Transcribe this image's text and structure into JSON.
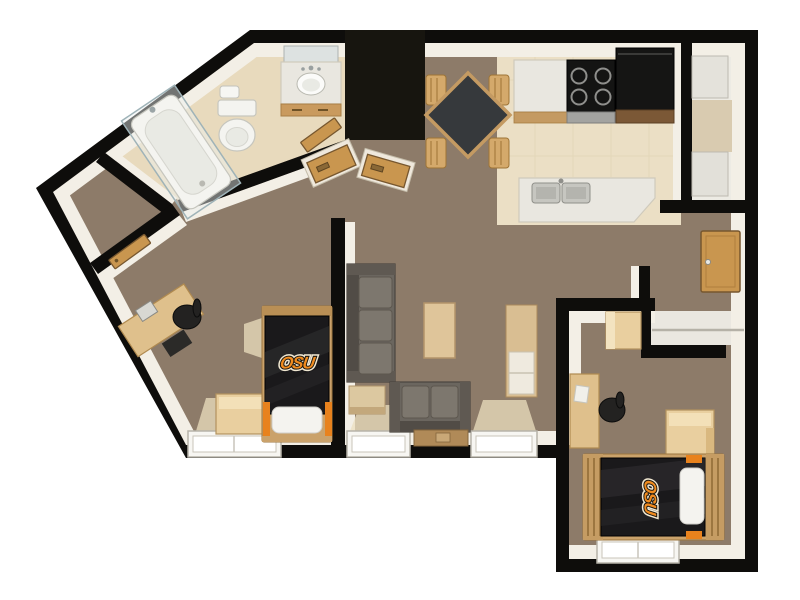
{
  "scene": {
    "type": "3d-floor-plan",
    "description": "Top-down 3D rendering of a two-bedroom university apartment with OSU-branded bedding",
    "brand": "OSU"
  },
  "colors": {
    "background": "#ffffff",
    "wall": "#0e0d0b",
    "wall_face": "#f3efe6",
    "carpet": "#8d7b69",
    "tile_bathroom": "#e8dabd",
    "tile_kitchen": "#ebdfc5",
    "utility_floor": "#edebe4",
    "closet_floor": "#eae7e0",
    "accent_orange": "#e8821d",
    "logo_orange": "#f08b1f",
    "bedding_black": "#1a191b",
    "wood_door": "#c9964f",
    "furniture_tan": "#e9cf9f",
    "sofa_gray": "#6b665f",
    "appliance_black": "#151514",
    "window_white": "#f7f6f2",
    "dining_table_top": "#36393c"
  },
  "logos": {
    "bedroom1_bed": "OSU",
    "bedroom2_bed": "OSU"
  },
  "rooms": [
    {
      "id": "bathroom",
      "floor": "tile",
      "furniture": [
        "bathtub-with-shower-enclosure",
        "toilet",
        "toilet-paper-roll",
        "vanity-with-sink",
        "mirror"
      ]
    },
    {
      "id": "walk-in-closet",
      "floor": "carpet",
      "furniture": []
    },
    {
      "id": "hallway",
      "floor": "carpet",
      "furniture": [
        "storage-closet-door-left",
        "storage-closet-door-right",
        "bedroom-door-leaf"
      ]
    },
    {
      "id": "kitchen",
      "floor": "tile",
      "furniture": [
        "counter",
        "stove-4-burner",
        "refrigerator",
        "base-cabinet",
        "peninsula-counter",
        "double-sink"
      ]
    },
    {
      "id": "dining-area",
      "floor": "carpet",
      "furniture": [
        "square-dining-table",
        "chair",
        "chair",
        "chair",
        "chair"
      ]
    },
    {
      "id": "utility-closet",
      "floor": "vinyl",
      "furniture": [
        "appliance-upper",
        "appliance-lower"
      ]
    },
    {
      "id": "entry",
      "floor": "carpet",
      "furniture": [
        "front-door"
      ]
    },
    {
      "id": "coat-closet",
      "floor": "vinyl",
      "furniture": [
        "shelf"
      ]
    },
    {
      "id": "living-room",
      "floor": "carpet",
      "furniture": [
        "sofa",
        "loveseat",
        "end-table",
        "coffee-table",
        "console-table",
        "bookshelf"
      ]
    },
    {
      "id": "bedroom-1",
      "floor": "carpet",
      "furniture": [
        "bed-osu-bedding",
        "pillow",
        "desk",
        "desk-chair",
        "computer-tower",
        "dresser-chest",
        "window"
      ]
    },
    {
      "id": "bedroom-2",
      "floor": "carpet",
      "furniture": [
        "bed-osu-bedding",
        "pillow",
        "desk",
        "desk-chair",
        "dresser-chest",
        "wardrobe-cabinet",
        "window"
      ]
    }
  ]
}
